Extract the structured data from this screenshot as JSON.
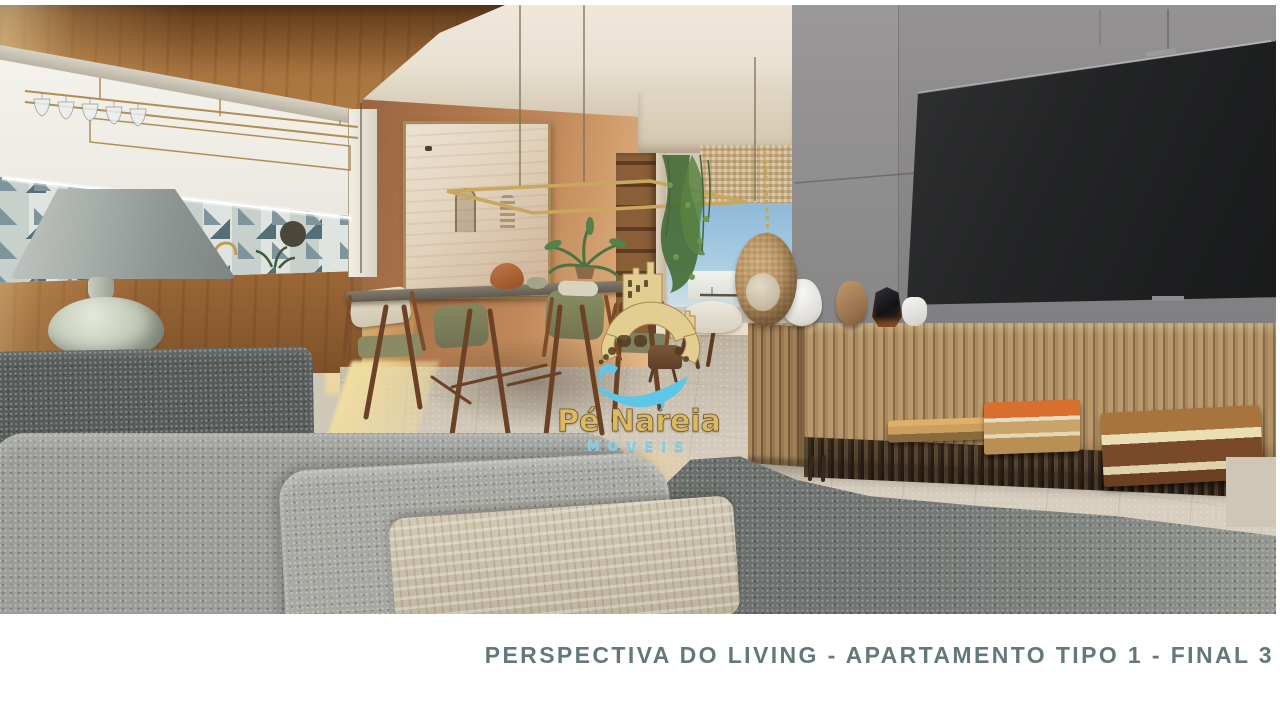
{
  "caption": {
    "text": "PERSPECTIVA DO LIVING - APARTAMENTO TIPO 1 - FINAL 3",
    "color": "#64777b"
  },
  "watermark": {
    "brand": "Pé Nareia",
    "line2": "MÓVEIS",
    "gold": "#e2cd92",
    "blue": "#5ec6e8"
  },
  "photo": {
    "type": "architectural-render",
    "scene_objects": [
      "wood panel wall",
      "kitchen pass-through niche",
      "wine glass rack",
      "geometric tile backsplash",
      "table lamp",
      "framed artwork",
      "pendant light",
      "dining table and chairs",
      "potted plant",
      "balcony with hanging plants",
      "hanging egg chair",
      "gray tv wall panel",
      "wall mounted tv",
      "slatted wood sideboard",
      "decor vases",
      "stacked books",
      "gray boucle sofa",
      "woven pillow"
    ]
  }
}
